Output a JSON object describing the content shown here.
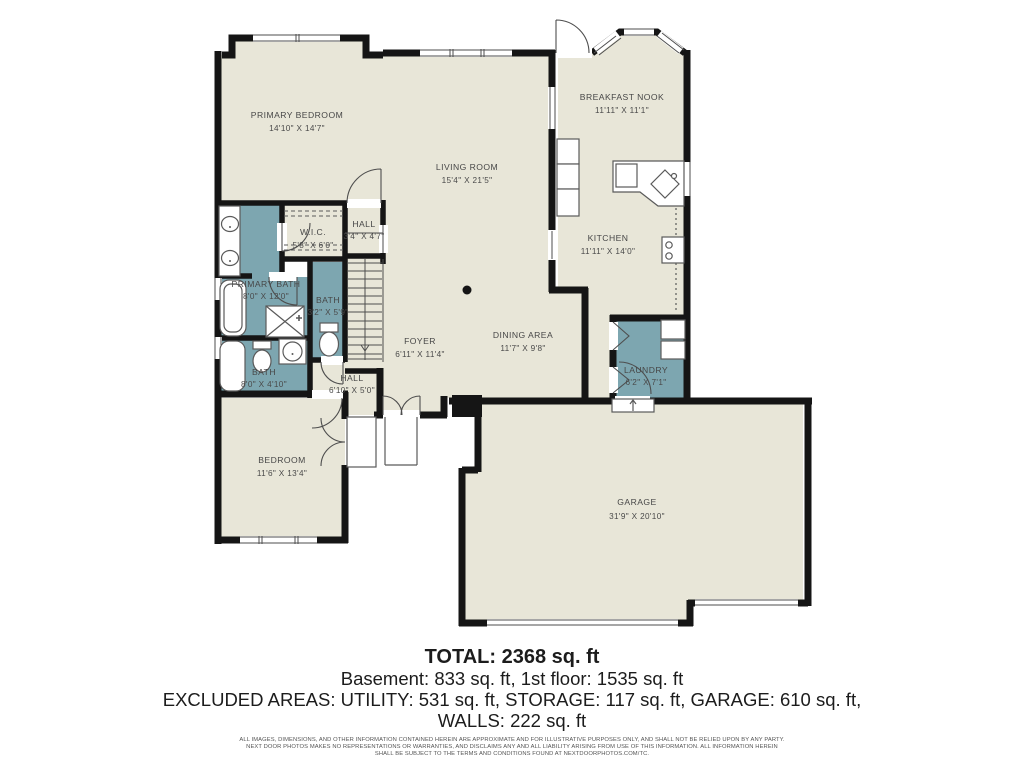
{
  "colors": {
    "floor": "#e8e6d8",
    "wet": "#7da6b0",
    "wall": "#151515",
    "thin_line": "#4e4e4e",
    "label": "#474747"
  },
  "rooms": {
    "primary_bedroom": {
      "name": "PRIMARY BEDROOM",
      "dims": "14'10\" X 14'7\""
    },
    "living_room": {
      "name": "LIVING ROOM",
      "dims": "15'4\" X 21'5\""
    },
    "breakfast_nook": {
      "name": "BREAKFAST NOOK",
      "dims": "11'11\" X 11'1\""
    },
    "kitchen": {
      "name": "KITCHEN",
      "dims": "11'11\" X 14'0\""
    },
    "wic": {
      "name": "W.I.C.",
      "dims": "5'8\" X 6'0\""
    },
    "hall_upper": {
      "name": "HALL",
      "dims": "3'4\" X 4'7\""
    },
    "primary_bath": {
      "name": "PRIMARY BATH",
      "dims": "8'0\" X 12'0\""
    },
    "bath_small": {
      "name": "BATH",
      "dims": "3'2\" X 5'9\""
    },
    "foyer": {
      "name": "FOYER",
      "dims": "6'11\" X 11'4\""
    },
    "dining_area": {
      "name": "DINING AREA",
      "dims": "11'7\" X 9'8\""
    },
    "laundry": {
      "name": "LAUNDRY",
      "dims": "6'2\" X 7'1\""
    },
    "bath_lower": {
      "name": "BATH",
      "dims": "8'0\" X 4'10\""
    },
    "hall_lower": {
      "name": "HALL",
      "dims": "6'10\" X 5'0\""
    },
    "bedroom": {
      "name": "BEDROOM",
      "dims": "11'6\" X 13'4\""
    },
    "garage": {
      "name": "GARAGE",
      "dims": "31'9\" X 20'10\""
    }
  },
  "summary": {
    "total": "TOTAL: 2368 sq. ft",
    "line2": "Basement: 833 sq. ft, 1st floor: 1535 sq. ft",
    "line3": "EXCLUDED AREAS: UTILITY: 531 sq. ft, STORAGE: 117 sq. ft, GARAGE: 610 sq. ft,",
    "line4": "WALLS: 222 sq. ft"
  },
  "disclaimer": {
    "line1": "ALL IMAGES, DIMENSIONS, AND OTHER INFORMATION CONTAINED HEREIN ARE APPROXIMATE AND FOR ILLUSTRATIVE PURPOSES ONLY, AND SHALL NOT BE RELIED UPON BY ANY PARTY.",
    "line2": "NEXT DOOR PHOTOS MAKES NO REPRESENTATIONS OR WARRANTIES, AND DISCLAIMS ANY AND ALL LIABILITY ARISING FROM USE OF THIS INFORMATION. ALL INFORMATION HEREIN",
    "line3": "SHALL BE SUBJECT TO THE TERMS AND CONDITIONS FOUND AT NEXTDOORPHOTOS.COM/TC."
  }
}
